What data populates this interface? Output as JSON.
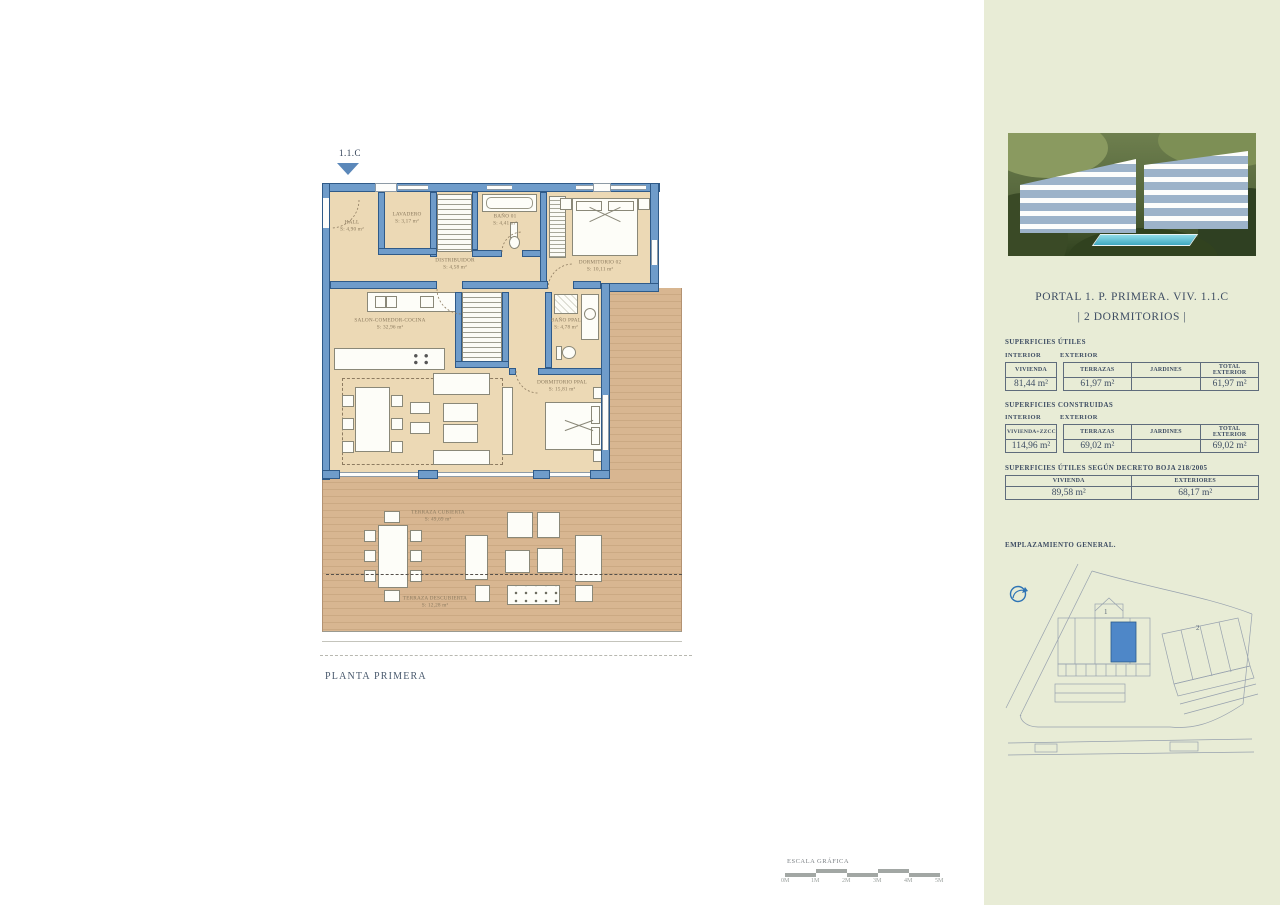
{
  "plan": {
    "marker": "1.1.C",
    "caption": "PLANTA PRIMERA",
    "rooms": [
      {
        "name": "HALL",
        "area": "S: 4,90  m²"
      },
      {
        "name": "LAVADERO",
        "area": "S: 3,17  m²"
      },
      {
        "name": "BAÑO 01",
        "area": "S: 4,41  m²"
      },
      {
        "name": "DISTRIBUIDOR",
        "area": "S: 4,58  m²"
      },
      {
        "name": "DORMITORIO 02",
        "area": "S: 10,11  m²"
      },
      {
        "name": "SALON-COMEDOR-COCINA",
        "area": "S: 32,96  m²"
      },
      {
        "name": "BAÑO PPAL",
        "area": "S: 4,78  m²"
      },
      {
        "name": "DORMITORIO PPAL",
        "area": "S: 15,81  m²"
      },
      {
        "name": "TERRAZA CUBIERTA",
        "area": "S: 49,69  m²"
      },
      {
        "name": "TERRAZA DESCUBIERTA",
        "area": "S: 12,28  m²"
      }
    ],
    "colors": {
      "wall": "#6f9cca",
      "floor": "#ecd9b5",
      "wood": "#d8b691",
      "marker_blue": "#5b88ba"
    }
  },
  "sidebar": {
    "title_line1": "PORTAL 1. P. PRIMERA. VIV. 1.1.C",
    "title_line2": "| 2 DORMITORIOS |",
    "utiles": {
      "heading": "SUPERFICIES ÚTILES",
      "interior_label": "INTERIOR",
      "exterior_label": "EXTERIOR",
      "headers": [
        "VIVIENDA",
        "TERRAZAS",
        "JARDINES",
        "TOTAL EXTERIOR"
      ],
      "values": [
        "81,44 m²",
        "61,97 m²",
        "",
        "61,97 m²"
      ]
    },
    "construidas": {
      "heading": "SUPERFICIES CONSTRUIDAS",
      "interior_label": "INTERIOR",
      "exterior_label": "EXTERIOR",
      "headers": [
        "VIVIENDA+ZZCC",
        "TERRAZAS",
        "JARDINES",
        "TOTAL EXTERIOR"
      ],
      "values": [
        "114,96 m²",
        "69,02 m²",
        "",
        "69,02 m²"
      ]
    },
    "boja": {
      "heading": "SUPERFICIES ÚTILES SEGÚN DECRETO BOJA 218/2005",
      "headers": [
        "VIVIENDA",
        "EXTERIORES"
      ],
      "values": [
        "89,58 m²",
        "68,17 m²"
      ]
    },
    "emplazamiento_heading": "EMPLAZAMIENTO GENERAL.",
    "siteplan": {
      "building1_label": "1",
      "building2_label": "2"
    },
    "colors": {
      "bg": "#e8ecd6",
      "text": "#3e4d63",
      "highlight_unit": "#4e87c8"
    }
  },
  "scalebar": {
    "label": "ESCALA GRÁFICA",
    "ticks": [
      "0M",
      "1M",
      "2M",
      "3M",
      "4M",
      "5M"
    ]
  }
}
